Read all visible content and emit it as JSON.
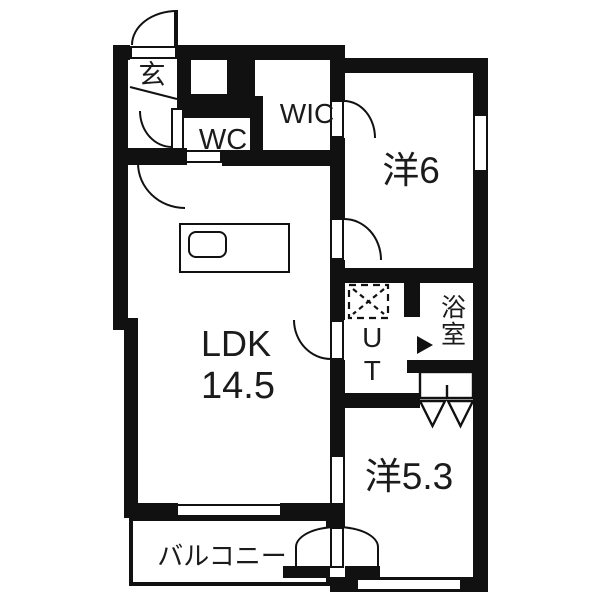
{
  "rooms": {
    "genkan": {
      "label": "玄"
    },
    "wc": {
      "label": "WC"
    },
    "wic": {
      "label": "WIC"
    },
    "western6": {
      "label": "洋6"
    },
    "ldk": {
      "name": "LDK",
      "size": "14.5"
    },
    "utility": {
      "label": "UT"
    },
    "bath": {
      "label": "浴室"
    },
    "western53": {
      "label": "洋5.3"
    },
    "balcony": {
      "label": "バルコニー"
    }
  },
  "colors": {
    "wall": "#111111",
    "background": "#ffffff",
    "text": "#1b1b1b"
  }
}
